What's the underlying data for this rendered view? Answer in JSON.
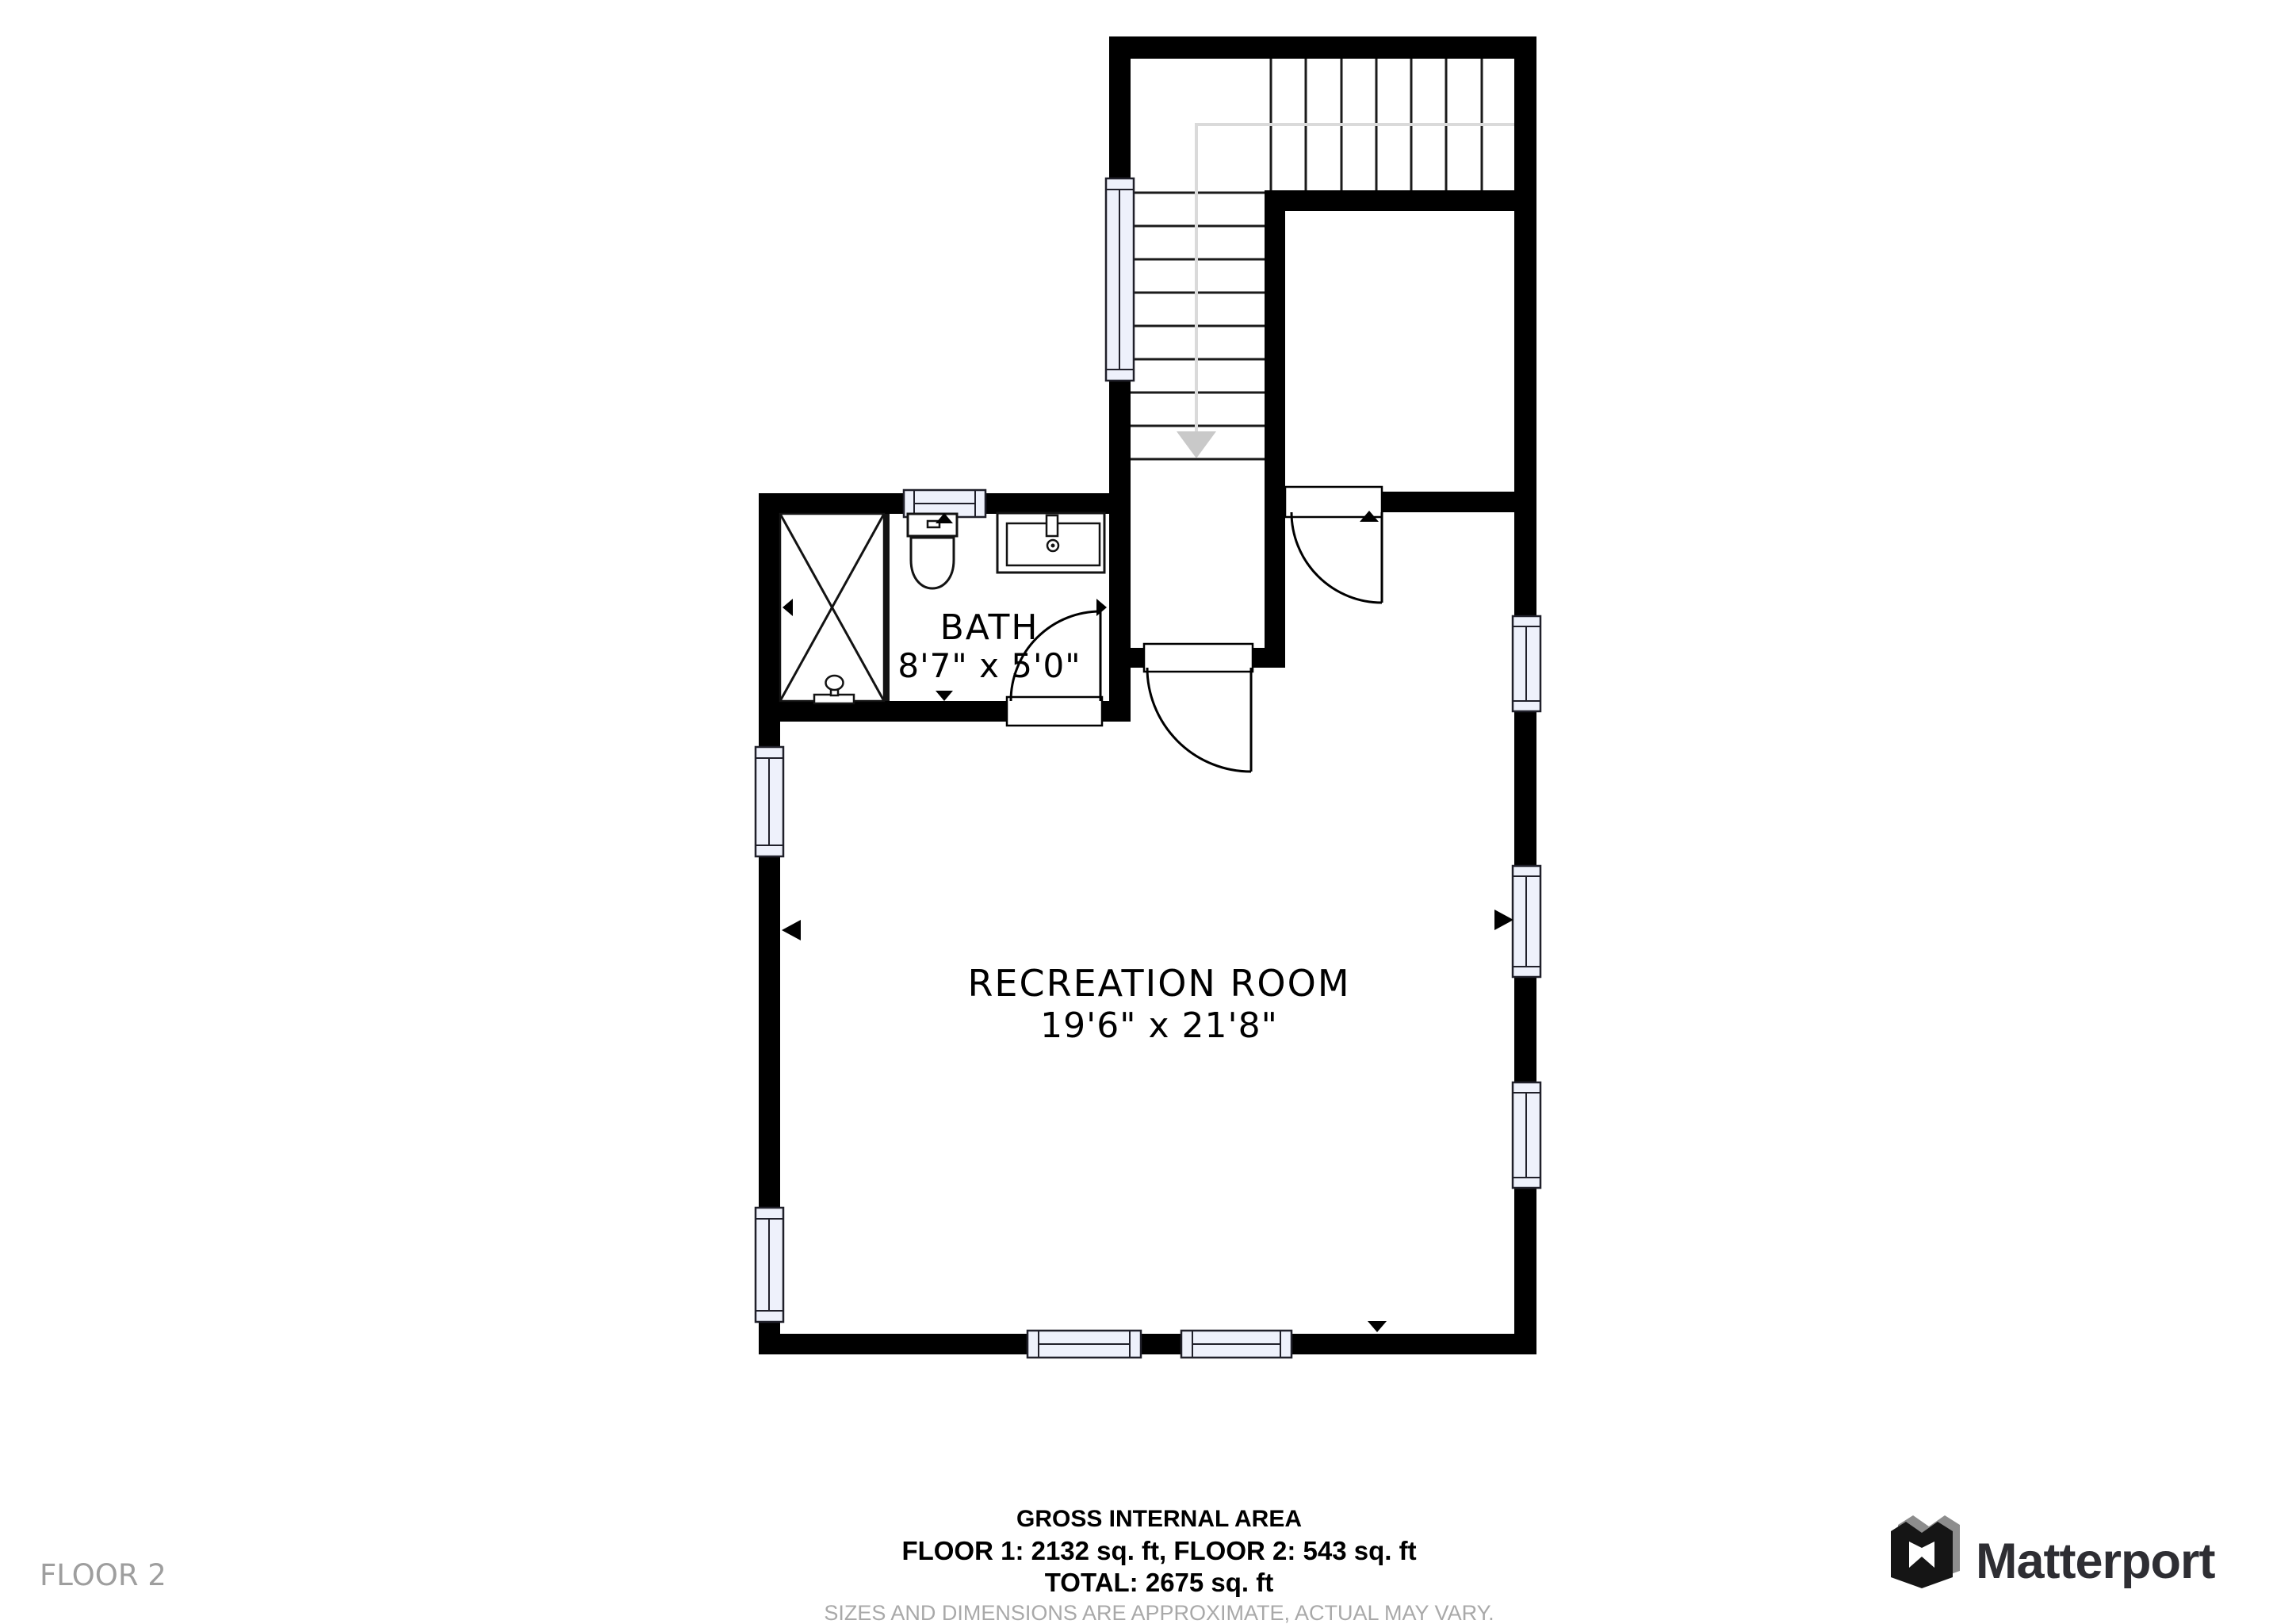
{
  "floor_label": "FLOOR 2",
  "rooms": [
    {
      "name": "BATH",
      "dimensions": "8'7\" x 5'0\""
    },
    {
      "name": "RECREATION ROOM",
      "dimensions": "19'6\" x 21'8\""
    }
  ],
  "footer": {
    "title": "GROSS INTERNAL AREA",
    "floors": "FLOOR 1: 2132 sq. ft, FLOOR 2: 543 sq. ft",
    "total": "TOTAL: 2675 sq. ft",
    "disclaimer": "SIZES AND DIMENSIONS ARE APPROXIMATE, ACTUAL MAY VARY."
  },
  "branding": {
    "wordmark": "Matterport",
    "logo_icon": "matterport-m-icon"
  },
  "plan": {
    "stairs": {
      "runs": 2,
      "direction_arrow": "down"
    },
    "doors": 3,
    "windows": 9,
    "fixtures": [
      "shower",
      "toilet",
      "sink"
    ]
  },
  "colors": {
    "wall": "#000000",
    "window_fill": "#eef1fb",
    "muted_text": "#9e9e9e",
    "disclaimer_text": "#a9a9a9",
    "walk_line": "#dadada",
    "brand_text": "#2e2e33",
    "brand_gray": "#8d8d8d"
  }
}
